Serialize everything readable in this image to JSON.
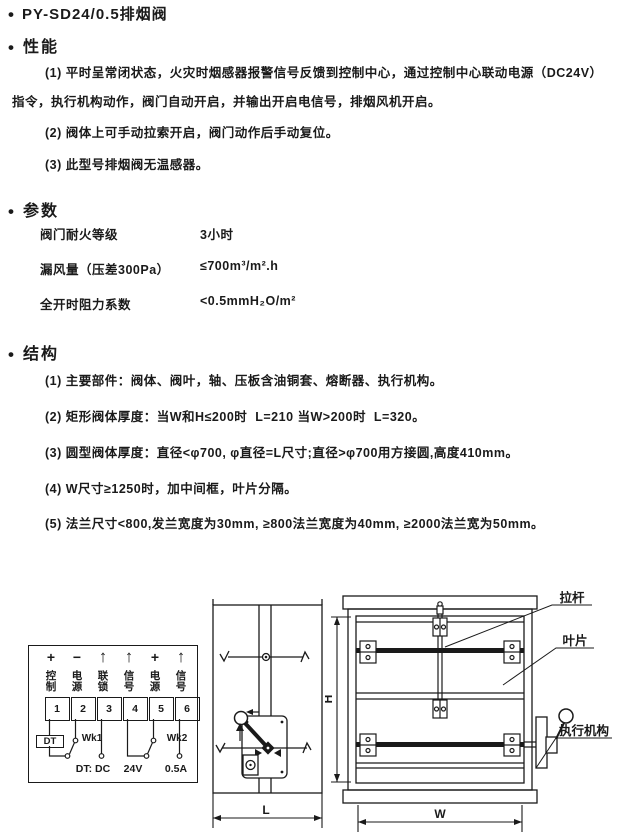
{
  "glyphs": {
    "bullet": "•"
  },
  "title": "PY-SD24/0.5排烟阀",
  "sections": {
    "performance": {
      "heading": "性能",
      "item1_line1": "(1) 平时呈常闭状态，火灾时烟感器报警信号反馈到控制中心，通过控制中心联动电源（DC24V）",
      "item1_line2": "指令，执行机构动作，阀门自动开启，并输出开启电信号，排烟风机开启。",
      "item2": "(2) 阀体上可手动拉索开启，阀门动作后手动复位。",
      "item3": "(3) 此型号排烟阀无温感器。"
    },
    "parameters": {
      "heading": "参数",
      "rows": [
        {
          "label": "阀门耐火等级",
          "value": "3小时"
        },
        {
          "label": "漏风量（压差300Pa）",
          "value": "≤700m³/m².h"
        },
        {
          "label": "全开时阻力系数",
          "value": "<0.5mmH₂O/m²"
        }
      ]
    },
    "structure": {
      "heading": "结构",
      "items": [
        "(1) 主要部件：阀体、阀叶，轴、压板含油铜套、熔断器、执行机构。",
        "(2) 矩形阀体厚度：当W和H≤200时  L=210 当W>200时  L=320。",
        "(3) 圆型阀体厚度：直径<φ700, φ直径=L尺寸;直径>φ700用方接圆,高度410mm。",
        "(4) W尺寸≥1250时，加中间框，叶片分隔。",
        "(5) 法兰尺寸<800,发兰宽度为30mm, ≥800法兰宽度为40mm, ≥2000法兰宽为50mm。"
      ]
    }
  },
  "wiring": {
    "terminals": [
      {
        "symbol": "+",
        "label": "控制",
        "num": "1"
      },
      {
        "symbol": "−",
        "label": "电源",
        "num": "2"
      },
      {
        "symbol": "↑",
        "label": "联锁",
        "num": "3"
      },
      {
        "symbol": "↑",
        "label": "信号",
        "num": "4"
      },
      {
        "symbol": "+",
        "label": "电源",
        "num": "5"
      },
      {
        "symbol": "↑",
        "label": "信号",
        "num": "6"
      }
    ],
    "dt_label": "DT",
    "wk1_label": "Wk1",
    "wk2_label": "Wk2",
    "note_dt": "DT: DC",
    "note_24v": "24V",
    "note_05a": "0.5A"
  },
  "drawings": {
    "dim_L": "L",
    "dim_W": "W",
    "dim_H": "H",
    "label_pull_rod": "拉杆",
    "label_blade": "叶片",
    "label_actuator": "执行机构"
  }
}
